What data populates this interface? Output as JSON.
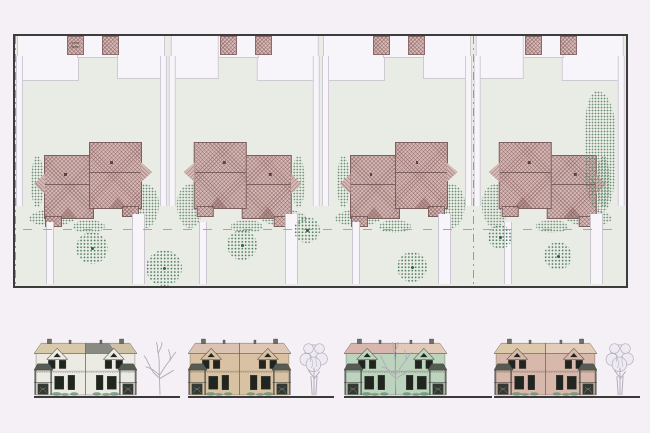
{
  "page": {
    "background": "#f4f0f6",
    "views": [
      "site-plan",
      "street-elevations"
    ]
  },
  "site_plan": {
    "shed_label": "STOR SHED",
    "colors": {
      "pagebg": "#f4f0f6",
      "ground": "#e9ebe5",
      "paving": "#f7f5f9",
      "planborder": "#3c3c3c",
      "rooffill": "#d5b9b6",
      "roofline": "#7d6060",
      "treedot": "#4f7f60",
      "shrubdot": "#5d8668",
      "lotline": "#9a96a0",
      "setback": "#a8a4ae"
    },
    "lots": [
      {
        "id": "lot-1",
        "mirrored": false,
        "shed_label": "STOR SHED"
      },
      {
        "id": "lot-2",
        "mirrored": true,
        "shed_label": ""
      },
      {
        "id": "lot-3",
        "mirrored": false,
        "shed_label": ""
      },
      {
        "id": "lot-4",
        "mirrored": true,
        "shed_label": ""
      }
    ],
    "trees": [
      {
        "x": 77,
        "y": 212,
        "r": 16
      },
      {
        "x": 149,
        "y": 232,
        "r": 18
      },
      {
        "x": 227,
        "y": 209,
        "r": 15
      },
      {
        "x": 292,
        "y": 194,
        "r": 13
      },
      {
        "x": 397,
        "y": 231,
        "r": 15
      },
      {
        "x": 485,
        "y": 201,
        "r": 12
      },
      {
        "x": 543,
        "y": 220,
        "r": 14
      }
    ]
  },
  "elevations": {
    "colors": {
      "window": "#20261f",
      "porchroof": "#565b54",
      "chimney": "#6f6f67",
      "groundline": "#3a3a3a",
      "treeline": "#b2aaba",
      "treefill": "#edebf1",
      "shrubgreen": "#6f9478"
    },
    "groups": [
      {
        "id": "elevation-1",
        "wall": "#ebeae3",
        "roof": "#d8caa9",
        "roof_right": "#cfc1a3",
        "roof_right_accent": "#8a8a85",
        "tree": "bare",
        "tree_position": "right"
      },
      {
        "id": "elevation-2",
        "wall": "#d9c2a3",
        "roof": "#dcc2b3",
        "roof_right": "#e0c7b5",
        "tree": "leafy",
        "tree_position": "right"
      },
      {
        "id": "elevation-3",
        "wall": "#bcd3bd",
        "roof": "#d8b5ad",
        "roof_right": "#e2c9b8",
        "tree": "bare",
        "tree_position": "center"
      },
      {
        "id": "elevation-4",
        "wall": "#d8b8ab",
        "roof": "#dbc9a9",
        "roof_right": "#e3ccba",
        "tree": "leafy",
        "tree_position": "right"
      }
    ]
  }
}
